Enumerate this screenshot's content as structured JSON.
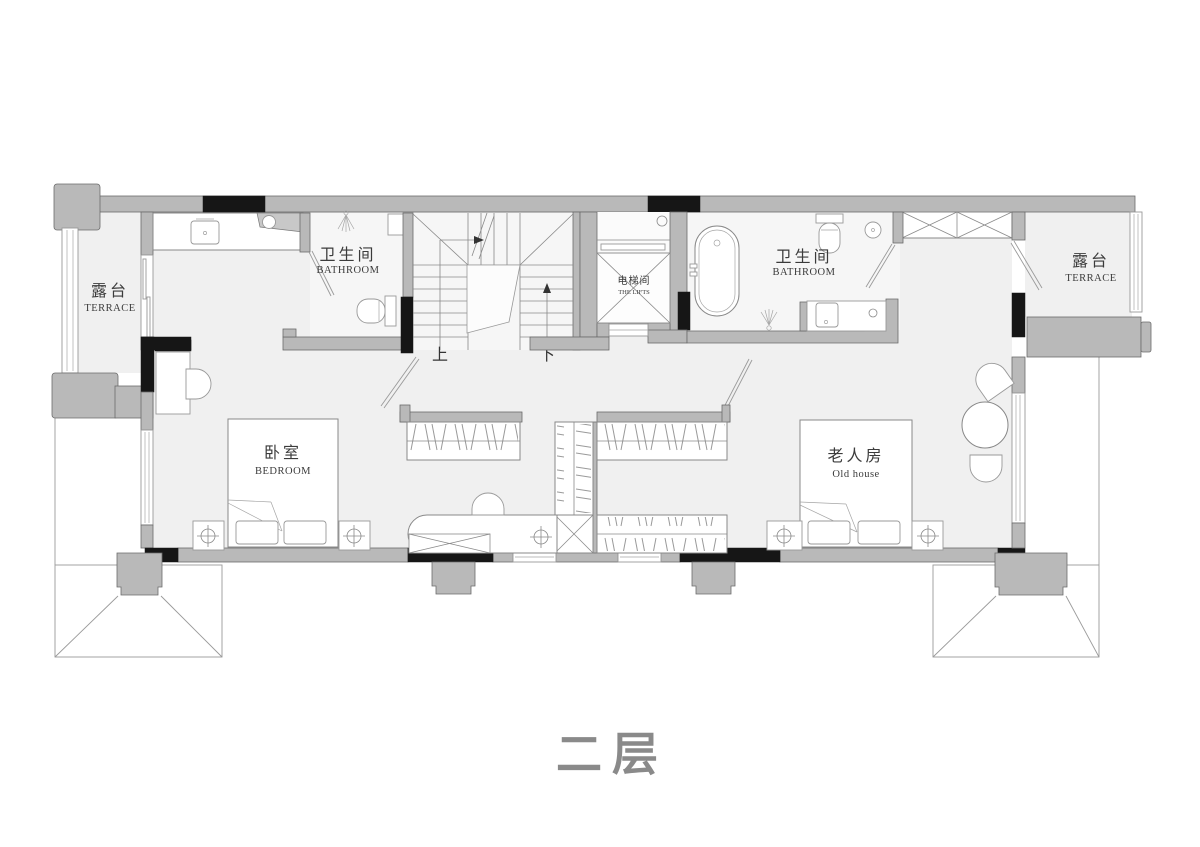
{
  "title": "二层",
  "rooms": {
    "terrace_left": {
      "zh": "露台",
      "en": "TERRACE"
    },
    "bathroom_left": {
      "zh": "卫生间",
      "en": "BATHROOM"
    },
    "lift": {
      "zh": "电梯间",
      "en": "THE LIFTS"
    },
    "bathroom_right": {
      "zh": "卫生间",
      "en": "BATHROOM"
    },
    "terrace_right": {
      "zh": "露台",
      "en": "TERRACE"
    },
    "bedroom": {
      "zh": "卧室",
      "en": "BEDROOM"
    },
    "elder_room": {
      "zh": "老人房",
      "en": "Old house"
    }
  },
  "stairs": {
    "up": "上",
    "down": "下"
  },
  "colors": {
    "wall": "#b9b9b9",
    "wall_dark": "#161616",
    "floor": "#f0f0f0",
    "line": "#8a8a8a",
    "title_text": "#8a8a8a"
  }
}
